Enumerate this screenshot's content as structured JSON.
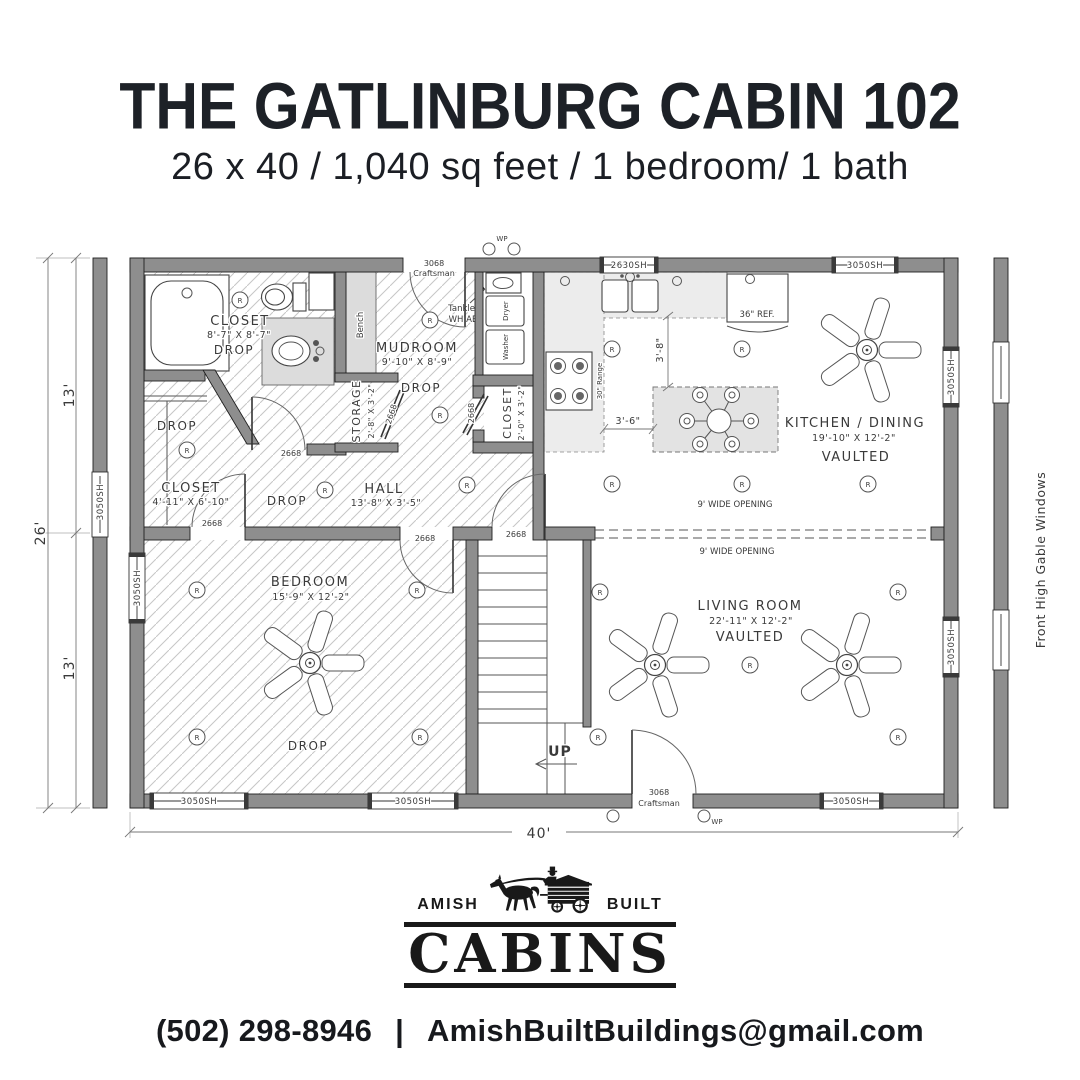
{
  "colors": {
    "wall": "#8e8e8e",
    "title_text": "#1d2127",
    "logo_ink": "#191919"
  },
  "header": {
    "title": "THE GATLINBURG CABIN 102",
    "subtitle": "26 x 40 / 1,040 sq feet / 1 bedroom/ 1 bath"
  },
  "plan": {
    "rooms": {
      "closet_master": {
        "name": "CLOSET",
        "dims": "8'-7\" X 8'-7\"",
        "note": "DROP"
      },
      "mudroom": {
        "name": "MUDROOM",
        "dims": "9'-10\" X 8'-9\"",
        "note": "DROP"
      },
      "storage": {
        "name": "STORAGE",
        "dims": "2'-8\" X 3'-2\""
      },
      "laundry_closet": {
        "name": "CLOSET",
        "dims": "2'-0\" X 3'-2\""
      },
      "bedroom_closet": {
        "name": "CLOSET",
        "dims": "4'-11\" X 6'-10\""
      },
      "hall": {
        "name": "HALL",
        "dims": "13'-8\" X 3'-5\""
      },
      "bedroom": {
        "name": "BEDROOM",
        "dims": "15'-9\" X 12'-2\"",
        "note": "DROP"
      },
      "kitchen": {
        "name": "KITCHEN / DINING",
        "dims": "19'-10\" X 12'-2\"",
        "note": "VAULTED"
      },
      "living": {
        "name": "LIVING ROOM",
        "dims": "22'-11\" X 12'-2\"",
        "note": "VAULTED"
      }
    },
    "labels": {
      "drop": "DROP",
      "bench": "Bench",
      "up": "UP",
      "tankless_1": "Tankless",
      "tankless_2": "WH ABV",
      "dryer": "Dryer",
      "washer": "Washer",
      "fridge": "36\" REF.",
      "range": "30\" Range",
      "wide_opening": "9' WIDE OPENING",
      "recessed": "R",
      "wp": "WP",
      "window_3050": "3050SH",
      "window_2630": "2630SH",
      "door_2668": "2668",
      "door_3068_line1": "3068",
      "door_3068_line2": "Craftsman",
      "gable_note": "Front High Gable Windows"
    },
    "dimensions": {
      "width_total": "40'",
      "height_total": "26'",
      "height_top": "13'",
      "height_bottom": "13'",
      "kitchen_gap_v": "3'-8\"",
      "kitchen_gap_h": "3'-6\""
    }
  },
  "logo": {
    "word_left": "AMISH",
    "word_right": "BUILT",
    "word_main": "CABINS"
  },
  "footer": {
    "phone": "(502) 298-8946",
    "separator": "|",
    "email": "AmishBuiltBuildings@gmail.com"
  }
}
